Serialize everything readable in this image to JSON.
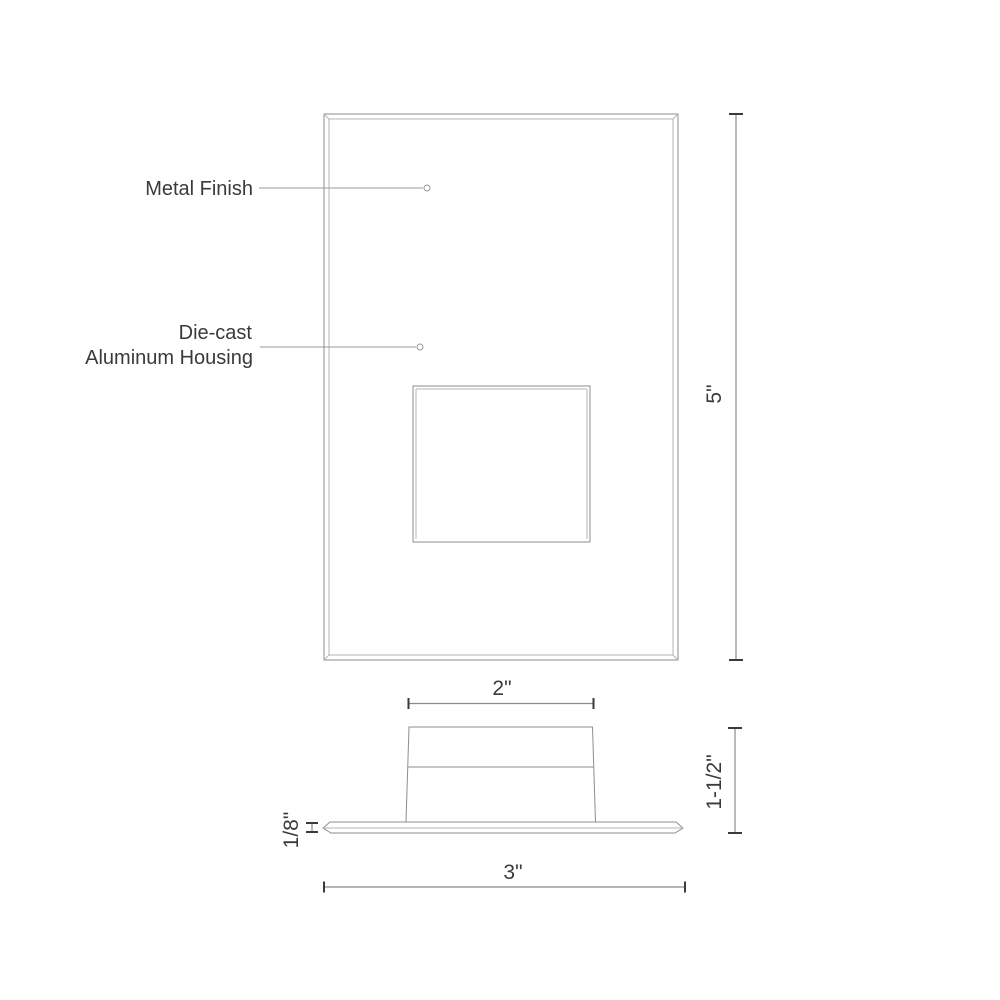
{
  "drawing": {
    "type": "product-dimension-drawing",
    "colors": {
      "background": "#ffffff",
      "outline": "#8e8e8e",
      "outline_light": "#b4b4b4",
      "leader": "#9a9a9a",
      "dimension_line": "#8a8a8a",
      "text": "#3a3a3a"
    },
    "front_view": {
      "callouts": {
        "metal_finish": "Metal Finish",
        "housing_line1": "Die-cast",
        "housing_line2": "Aluminum Housing"
      },
      "dimensions": {
        "overall_height": "5\""
      }
    },
    "side_view": {
      "dimensions": {
        "body_width": "2\"",
        "body_height": "1-1/2\"",
        "faceplate_thickness": "1/8\"",
        "faceplate_width": "3\""
      }
    }
  }
}
